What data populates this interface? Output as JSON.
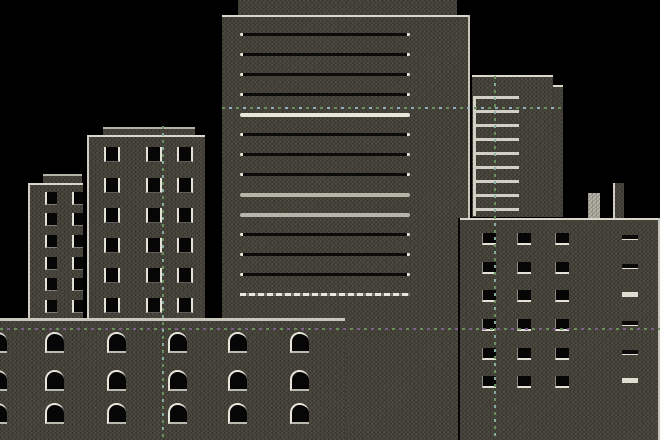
{
  "scene": {
    "width": 660,
    "height": 440,
    "background": "#000000"
  },
  "palette": {
    "building_base": "#46443a",
    "highlight": "#d9d7cb",
    "window": "#060606",
    "band_dark": "#0b0b0b",
    "band_gray": "#b7b5a9",
    "band_light": "#e9e7db",
    "antenna_light": "#b3b1a4",
    "green": "#6a945e",
    "teal": "#86b3a4",
    "blue": "#93b4c6",
    "purple": "#7e5f93"
  },
  "buildings": [
    {
      "name": "tower-parapet",
      "x": 238,
      "y": 0,
      "w": 219,
      "h": 16,
      "edges": []
    },
    {
      "name": "central-tower",
      "x": 222,
      "y": 15,
      "w": 248,
      "h": 425,
      "edges": [
        "top",
        "right"
      ],
      "bands": {
        "x": 240,
        "w": 170,
        "items": [
          {
            "y": 33,
            "style": "dark"
          },
          {
            "y": 53,
            "style": "dark"
          },
          {
            "y": 73,
            "style": "dark"
          },
          {
            "y": 93,
            "style": "dark"
          },
          {
            "y": 113,
            "style": "light"
          },
          {
            "y": 133,
            "style": "dark"
          },
          {
            "y": 153,
            "style": "dark"
          },
          {
            "y": 173,
            "style": "dark"
          },
          {
            "y": 193,
            "style": "gray"
          },
          {
            "y": 213,
            "style": "gray"
          },
          {
            "y": 233,
            "style": "dark"
          },
          {
            "y": 253,
            "style": "dark"
          },
          {
            "y": 273,
            "style": "dark"
          },
          {
            "y": 293,
            "style": "light-dashed"
          }
        ]
      }
    },
    {
      "name": "ladder-annex",
      "x": 545,
      "y": 85,
      "w": 18,
      "h": 132,
      "edges": [
        "top"
      ]
    },
    {
      "name": "ladder-building",
      "x": 472,
      "y": 75,
      "w": 81,
      "h": 142,
      "edges": [
        "top"
      ],
      "rungs": {
        "x": 1,
        "w": 46,
        "rail": {
          "x": 1,
          "w": 3,
          "top": 96,
          "bottom": 213
        },
        "ys": [
          96,
          110,
          124,
          138,
          152,
          166,
          180,
          194,
          208
        ]
      }
    },
    {
      "name": "small-parapet",
      "x": 43,
      "y": 174,
      "w": 39,
      "h": 10,
      "edges": [
        "topDim"
      ]
    },
    {
      "name": "small-building",
      "x": 28,
      "y": 183,
      "w": 55,
      "h": 257,
      "edges": [
        "top",
        "left"
      ],
      "windows": {
        "style": "left",
        "cols": [
          45,
          72
        ],
        "rows": [
          192,
          213,
          235,
          257,
          278,
          300
        ],
        "w": 12,
        "h": 13
      }
    },
    {
      "name": "leftmid-parapet",
      "x": 103,
      "y": 127,
      "w": 92,
      "h": 9,
      "edges": [
        "topDim"
      ]
    },
    {
      "name": "leftmid-building",
      "x": 87,
      "y": 135,
      "w": 118,
      "h": 305,
      "edges": [
        "top",
        "left"
      ],
      "windows": {
        "style": "sides",
        "cols": [
          104,
          146,
          177
        ],
        "rows": [
          147,
          178,
          208,
          238,
          268,
          298
        ],
        "w": 16,
        "h": 15
      }
    },
    {
      "name": "antenna-left",
      "x": 588,
      "y": 193,
      "w": 12,
      "h": 26,
      "edges": [],
      "fill": "antenna_light"
    },
    {
      "name": "antenna-right",
      "x": 613,
      "y": 183,
      "w": 11,
      "h": 36,
      "edges": [
        "left"
      ]
    },
    {
      "name": "right-building",
      "x": 458,
      "y": 218,
      "w": 202,
      "h": 222,
      "edges": [
        "top",
        "leftDark",
        "right"
      ],
      "windows": {
        "style": "square",
        "cols": [
          482,
          517,
          555
        ],
        "rows": [
          233,
          262,
          290,
          319,
          348,
          376
        ],
        "w": 14,
        "h": 12
      },
      "slits": {
        "col": 622,
        "w": 16,
        "h": 5,
        "rows": [
          235,
          264,
          292,
          321,
          350,
          378
        ],
        "pattern": [
          "dark",
          "dark",
          "light",
          "dark",
          "dark",
          "light"
        ]
      }
    },
    {
      "name": "foreground-building",
      "x": 0,
      "y": 318,
      "w": 345,
      "h": 122,
      "edges": [
        "topThick"
      ],
      "windows": {
        "style": "arch",
        "cols": [
          -12,
          45,
          107,
          168,
          228,
          290
        ],
        "rows": [
          332,
          370,
          403
        ],
        "w": 19,
        "h": 21
      }
    }
  ],
  "guide_lines": [
    {
      "name": "guide-h-upper",
      "orient": "h",
      "x": 222,
      "y": 107,
      "len": 341,
      "colors": [
        "green",
        "blue"
      ]
    },
    {
      "name": "guide-h-lower",
      "orient": "h",
      "x": 0,
      "y": 328,
      "len": 660,
      "colors": [
        "green",
        "purple"
      ]
    },
    {
      "name": "guide-v-left",
      "orient": "v",
      "x": 162,
      "y": 126,
      "len": 314,
      "colors": [
        "green",
        "teal"
      ]
    },
    {
      "name": "guide-v-right",
      "orient": "v",
      "x": 494,
      "y": 76,
      "len": 364,
      "colors": [
        "green",
        "teal"
      ]
    }
  ]
}
